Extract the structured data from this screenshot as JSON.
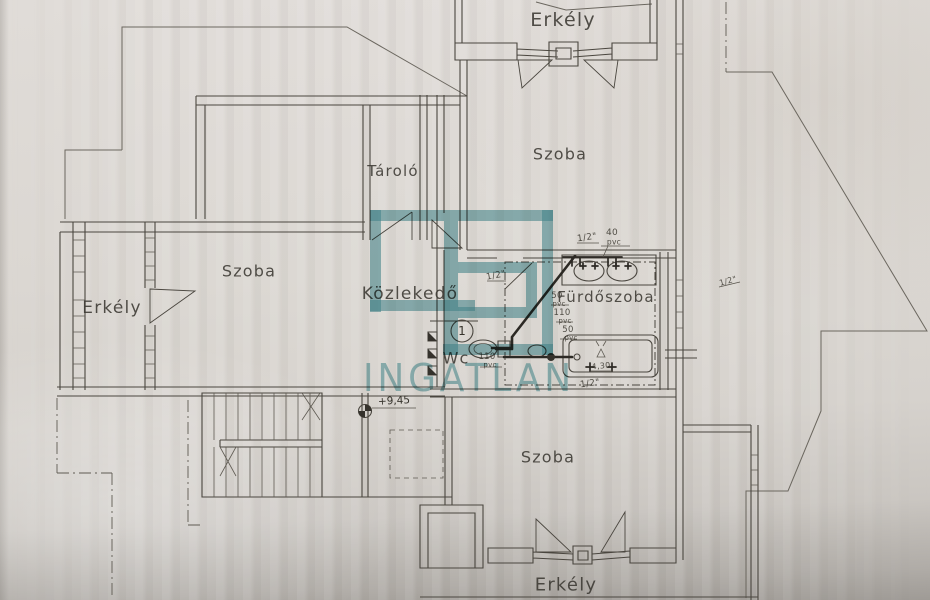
{
  "page": {
    "type": "floor-plan-photo",
    "paper_color": "#d9d5d0",
    "ink_color": "#47443f"
  },
  "watermark": {
    "brand": "INGATLAN",
    "color": "#4d9aa3"
  },
  "rooms": {
    "erkely_top": "Erkély",
    "szoba_top": "Szoba",
    "tarolo": "Tároló",
    "szoba_left": "Szoba",
    "erkely_left": "Erkély",
    "kozlekedo": "Közlekedő",
    "furdoszoba": "Fürdőszoba",
    "wc": "Wc",
    "szoba_bottom": "Szoba",
    "erkely_bottom": "Erkély"
  },
  "markers": {
    "level": "+9,45",
    "fixture_number": "1"
  },
  "pipe_annotations": [
    {
      "text": "1/2\""
    },
    {
      "text": "40"
    },
    {
      "text": "pvc"
    },
    {
      "text": "1/2\""
    },
    {
      "text": "50"
    },
    {
      "text": "pvc"
    },
    {
      "text": "110"
    },
    {
      "text": "pvc"
    },
    {
      "text": "50"
    },
    {
      "text": "pvc"
    },
    {
      "text": "110"
    },
    {
      "text": "pvc"
    },
    {
      "text": "1/2\""
    },
    {
      "text": "1/2\""
    },
    {
      "text": "4,30"
    }
  ]
}
